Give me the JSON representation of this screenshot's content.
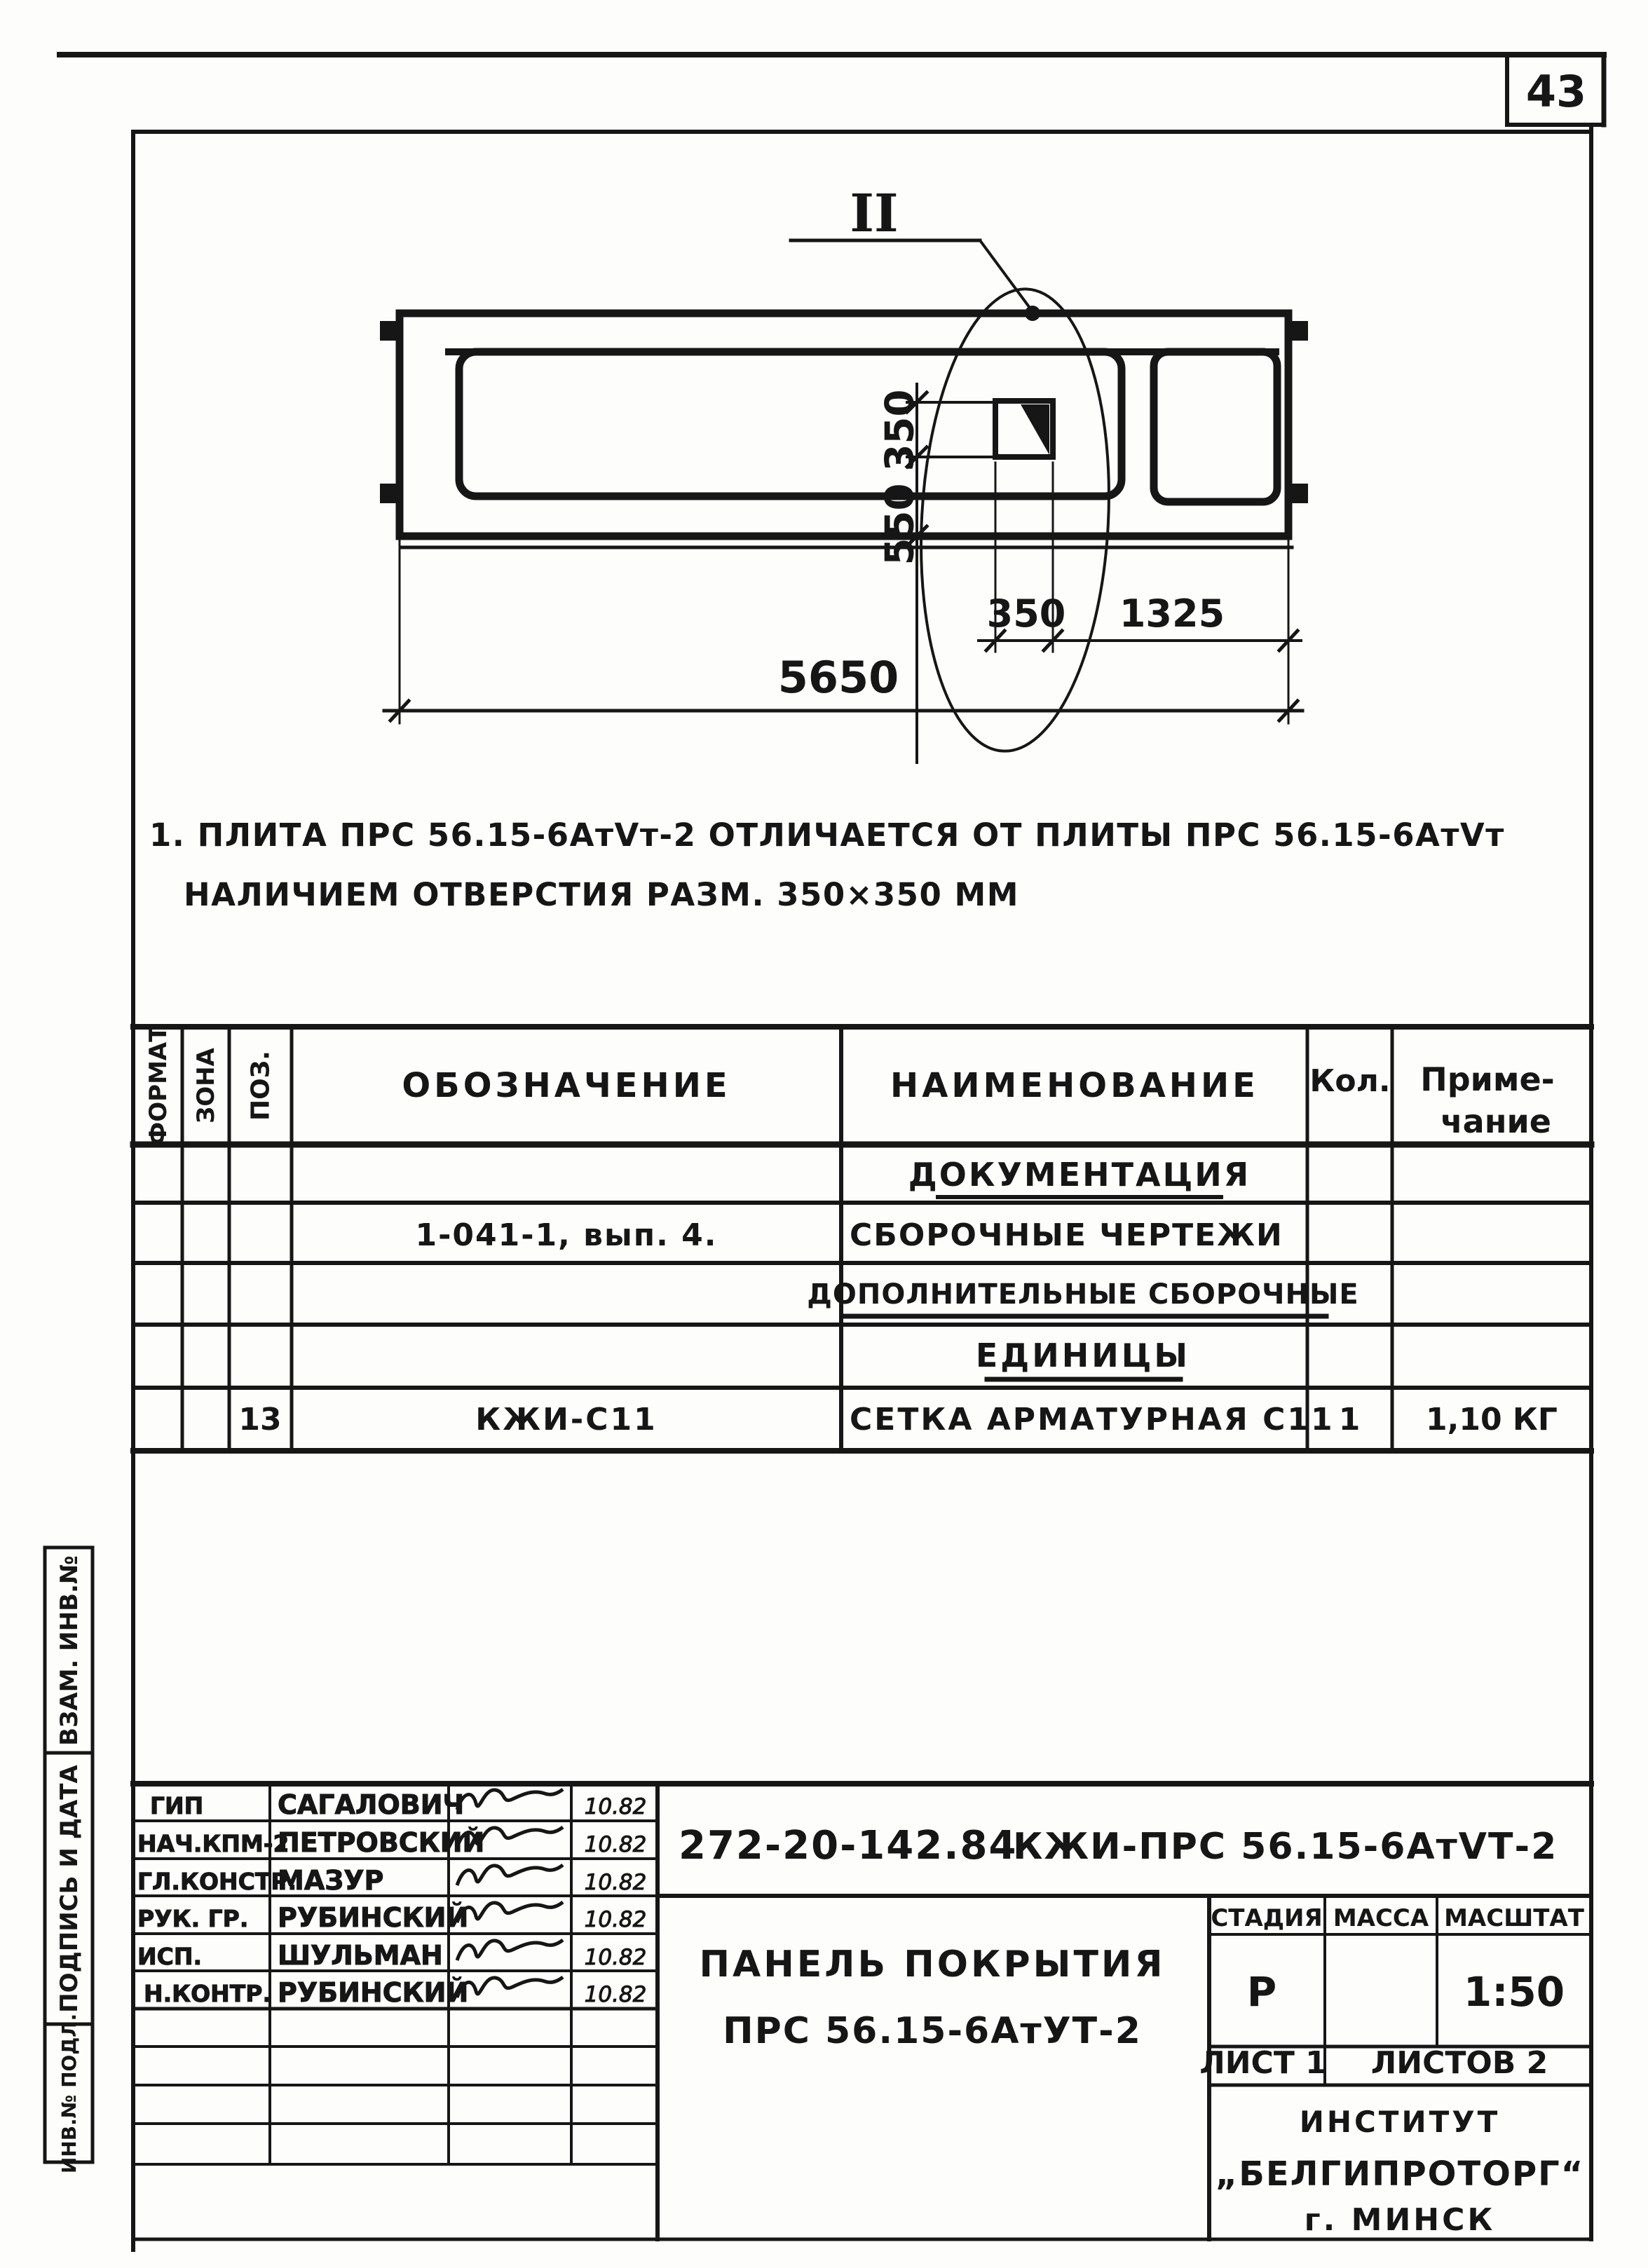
{
  "page_number": "43",
  "drawing": {
    "detail_label": "II",
    "dim_hole_height": "350",
    "dim_hole_offset_v": "550",
    "dim_hole_width": "350",
    "dim_hole_offset_h": "1325",
    "dim_overall_length": "5650"
  },
  "notes": {
    "line1": "1. ПЛИТА ПРС 56.15-6АтVт-2  ОТЛИЧАЕТСЯ  ОТ ПЛИТЫ  ПРС 56.15-6АтVт",
    "line2": "НАЛИЧИЕМ ОТВЕРСТИЯ  РАЗМ. 350×350 ММ"
  },
  "spec_table": {
    "headers": {
      "format": "ФОРМАТ",
      "zone": "ЗОНА",
      "position": "ПОЗ.",
      "designation": "ОБОЗНАЧЕНИЕ",
      "name": "НАИМЕНОВАНИЕ",
      "qty": "Кол.",
      "note1": "Приме-",
      "note2": "чание"
    },
    "rows": [
      {
        "name": "ДОКУМЕНТАЦИЯ"
      },
      {
        "designation": "1-041-1, вып. 4.",
        "name": "СБОРОЧНЫЕ ЧЕРТЕЖИ"
      },
      {
        "name": "ДОПОЛНИТЕЛЬНЫЕ СБОРОЧНЫЕ"
      },
      {
        "name": "ЕДИНИЦЫ"
      },
      {
        "pos": "13",
        "designation": "КЖИ-С11",
        "name": "СЕТКА АРМАТУРНАЯ С11",
        "qty": "1",
        "note": "1,10 КГ"
      }
    ]
  },
  "side_strip": {
    "cell1": "ВЗАМ. ИНВ.№",
    "cell2": "ПОДПИСЬ И ДАТА",
    "cell3": "ИНВ.№ ПОДЛ."
  },
  "title_block": {
    "doc_number": "272-20-142.84",
    "doc_code": "КЖИ-ПРС 56.15-6АтVТ-2",
    "title_line1": "ПАНЕЛЬ ПОКРЫТИЯ",
    "title_line2": "ПРС 56.15-6АтУТ-2",
    "stage_header": "СТАДИЯ",
    "mass_header": "МАССА",
    "scale_header": "МАСШТАТ",
    "stage": "Р",
    "scale": "1:50",
    "sheet": "ЛИСТ 1",
    "sheets": "ЛИСТОВ 2",
    "institute_line1": "ИНСТИТУТ",
    "institute_line2": "„БЕЛГИПРОТОРГ“",
    "institute_line3": "г. МИНСК",
    "signatures": [
      {
        "role": "ГИП",
        "name": "САГАЛОВИЧ",
        "date": "10.82"
      },
      {
        "role": "НАЧ.КПМ-2",
        "name": "ПЕТРОВСКИЙ",
        "date": "10.82"
      },
      {
        "role": "ГЛ.КОНСТР.",
        "name": "МАЗУР",
        "date": "10.82"
      },
      {
        "role": "РУК. ГР.",
        "name": "РУБИНСКИЙ",
        "date": "10.82"
      },
      {
        "role": "ИСП.",
        "name": "ШУЛЬМАН",
        "date": "10.82"
      },
      {
        "role": "Н.КОНТР.",
        "name": "РУБИНСКИЙ",
        "date": "10.82"
      }
    ]
  }
}
